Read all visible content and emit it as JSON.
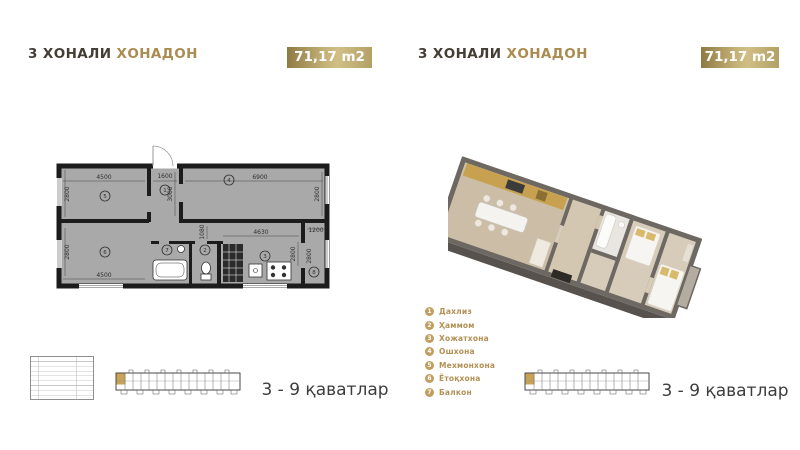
{
  "colors": {
    "gold_accent": "#ab8c50",
    "legend_gold": "#b29055",
    "badge_gradient": [
      "#8f7a44",
      "#d0be86",
      "#b3a065"
    ],
    "plan_room_fill": "#a9a9a9",
    "plan_wall": "#1c1c1c",
    "floors_text": "#3d3d3d"
  },
  "panels": {
    "left": {
      "title": {
        "primary": "3 ХОНАЛИ",
        "accent": "ХОНАДОН"
      },
      "area_badge": "71,17 m2",
      "floors_label": "3 - 9 қаватлар",
      "plan2d": {
        "dims": {
          "room5_w": "4500",
          "room5_h": "2800",
          "room6_w": "4500",
          "room6_h": "2800",
          "hall_w": "1600",
          "hall_h": "3000",
          "room4_w": "6900",
          "room4_h": "2800",
          "kitchen_w": "4630",
          "kitchen_h": "2800",
          "balcony_w": "1200",
          "balcony_h": "2800",
          "corridor": "1080"
        },
        "room_numbers": {
          "hall": "1",
          "wc": "2",
          "kitchen": "3",
          "living": "4",
          "bedroom1": "5",
          "bedroom2": "6",
          "bath": "7",
          "balcony": "8"
        }
      }
    },
    "right": {
      "title": {
        "primary": "3 ХОНАЛИ",
        "accent": "ХОНАДОН"
      },
      "area_badge": "71,17 m2",
      "floors_label": "3 - 9 қаватлар",
      "legend": [
        {
          "num": "1",
          "label": "Дахлиз"
        },
        {
          "num": "2",
          "label": "Ҳаммом"
        },
        {
          "num": "3",
          "label": "Хожатхона"
        },
        {
          "num": "4",
          "label": "Ошхона"
        },
        {
          "num": "5",
          "label": "Мехмонхона"
        },
        {
          "num": "6",
          "label": "Ётоқхона"
        },
        {
          "num": "7",
          "label": "Балкон"
        }
      ]
    }
  }
}
